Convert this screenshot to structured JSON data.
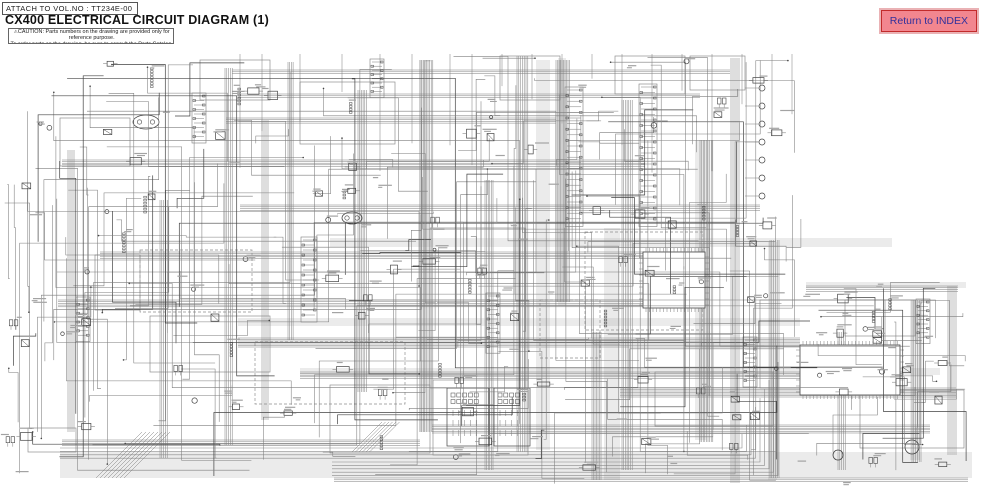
{
  "header": {
    "attach_label": "ATTACH TO VOL.NO : TT234E-00",
    "title": "CX400 ELECTRICAL CIRCUIT DIAGRAM (1)",
    "caution": {
      "icon": "⚠",
      "line1": "CAUTION: Parts numbers on the drawing are provided only for reference purpose.",
      "line2": "To order parts on the drawing, be sure to consult the Parts Catalog."
    }
  },
  "index_button": {
    "label": "Return to INDEX",
    "bg": "#f2868f",
    "border": "#c22b2b",
    "bevel": "#eab2b5",
    "text_color": "#30309c"
  },
  "diagram": {
    "description": "dense gray electrical schematic, empty top-right corner, horizontal bus lines along bottom",
    "canvas": {
      "w": 983,
      "h": 490
    },
    "seed": 20240917,
    "colors": {
      "wire": "#7d7d7d",
      "comp": "#434343",
      "smudge": "#a3a3a3",
      "module": "#8f8f8f",
      "band": "#777777",
      "bus": "#8a8a8a"
    },
    "bands": [
      [
        536,
        60,
        14,
        390
      ],
      [
        558,
        58,
        8,
        248
      ],
      [
        604,
        228,
        16,
        252
      ],
      [
        695,
        140,
        11,
        300
      ],
      [
        419,
        60,
        7,
        372
      ],
      [
        768,
        242,
        9,
        238
      ],
      [
        910,
        300,
        10,
        160
      ],
      [
        330,
        238,
        562,
        9
      ],
      [
        238,
        318,
        562,
        8
      ],
      [
        300,
        368,
        640,
        7
      ],
      [
        60,
        452,
        912,
        26
      ],
      [
        806,
        282,
        160,
        6
      ]
    ],
    "modules": [
      [
        60,
        118,
        70,
        48,
        0
      ],
      [
        140,
        250,
        112,
        62,
        1
      ],
      [
        150,
        316,
        120,
        56,
        0
      ],
      [
        255,
        342,
        150,
        62,
        1
      ],
      [
        300,
        82,
        95,
        62,
        0
      ],
      [
        430,
        228,
        95,
        160,
        0
      ],
      [
        585,
        232,
        118,
        98,
        1
      ],
      [
        433,
        380,
        95,
        75,
        0
      ],
      [
        655,
        372,
        118,
        54,
        0
      ],
      [
        760,
        300,
        125,
        88,
        0
      ],
      [
        200,
        60,
        70,
        40,
        0
      ],
      [
        95,
        255,
        45,
        55,
        0
      ],
      [
        500,
        56,
        60,
        44,
        0
      ],
      [
        615,
        56,
        70,
        38,
        0
      ],
      [
        860,
        390,
        104,
        58,
        0
      ],
      [
        28,
        428,
        48,
        24,
        0
      ],
      [
        330,
        385,
        100,
        68,
        0
      ],
      [
        690,
        56,
        55,
        34,
        0
      ],
      [
        540,
        300,
        60,
        58,
        1
      ],
      [
        845,
        300,
        70,
        36,
        0
      ]
    ],
    "v_bundles": [
      [
        225,
        68,
        445,
        5,
        1.8
      ],
      [
        420,
        60,
        432,
        9,
        1.6
      ],
      [
        517,
        56,
        452,
        7,
        1.8
      ],
      [
        556,
        60,
        302,
        10,
        1.5
      ],
      [
        622,
        100,
        470,
        7,
        1.7
      ],
      [
        700,
        140,
        442,
        9,
        1.6
      ],
      [
        731,
        58,
        483,
        5,
        2
      ],
      [
        770,
        240,
        478,
        6,
        1.8
      ],
      [
        912,
        300,
        462,
        6,
        1.8
      ],
      [
        948,
        286,
        455,
        5,
        2
      ],
      [
        358,
        90,
        392,
        6,
        1.7
      ],
      [
        262,
        120,
        420,
        4,
        2
      ],
      [
        68,
        150,
        432,
        4,
        2
      ],
      [
        160,
        200,
        458,
        5,
        1.8
      ],
      [
        485,
        180,
        470,
        6,
        1.6
      ],
      [
        592,
        332,
        480,
        7,
        1.5
      ],
      [
        838,
        332,
        470,
        5,
        1.8
      ],
      [
        288,
        62,
        340,
        4,
        1.7
      ]
    ],
    "h_bundles": [
      [
        70,
        232,
        730,
        3,
        1.8
      ],
      [
        118,
        226,
        556,
        4,
        1.7
      ],
      [
        160,
        62,
        645,
        5,
        1.6
      ],
      [
        205,
        240,
        760,
        4,
        1.8
      ],
      [
        252,
        100,
        700,
        5,
        1.6
      ],
      [
        300,
        58,
        700,
        5,
        1.7
      ],
      [
        338,
        238,
        800,
        7,
        1.5
      ],
      [
        372,
        300,
        903,
        5,
        1.6
      ],
      [
        388,
        620,
        956,
        7,
        1.5
      ],
      [
        425,
        432,
        930,
        6,
        1.6
      ],
      [
        440,
        62,
        420,
        4,
        1.8
      ],
      [
        286,
        806,
        958,
        4,
        1.8
      ],
      [
        94,
        238,
        700,
        3,
        1.8
      ],
      [
        478,
        334,
        968,
        3,
        1.8
      ]
    ],
    "bus": [
      [
        448,
        4,
        3.4,
        60
      ],
      [
        462,
        5,
        3.4,
        332
      ]
    ],
    "fans": [
      [
        96,
        478,
        8,
        4,
        46
      ],
      [
        352,
        452,
        6,
        3.5,
        30
      ]
    ],
    "strips": [
      [
        567,
        90,
        24,
        5.6,
        14
      ],
      [
        641,
        87,
        25,
        5.5,
        14
      ],
      [
        303,
        240,
        16,
        5,
        12
      ],
      [
        488,
        296,
        12,
        4.6,
        10
      ],
      [
        194,
        96,
        10,
        4.5,
        10
      ],
      [
        745,
        340,
        10,
        4.5,
        10
      ],
      [
        918,
        302,
        9,
        4.4,
        10
      ],
      [
        372,
        62,
        8,
        4.2,
        10
      ],
      [
        78,
        300,
        9,
        4.4,
        10
      ]
    ],
    "grids": [
      [
        447,
        388,
        42,
        58
      ],
      [
        494,
        388,
        36,
        58
      ]
    ],
    "pin_blocks": [
      [
        800,
        345,
        100,
        50
      ],
      [
        643,
        252,
        62,
        56
      ]
    ],
    "lamp_column": [
      762,
      88,
      7,
      18,
      3
    ],
    "ovals": [
      [
        146,
        122,
        13,
        7
      ],
      [
        352,
        218,
        10,
        6
      ]
    ],
    "circles": [
      [
        912,
        447,
        7
      ],
      [
        838,
        455,
        5
      ]
    ],
    "top_drops": [
      240,
      262,
      300,
      342,
      380,
      412,
      450,
      472,
      502,
      532,
      562,
      592,
      622,
      652,
      682,
      712,
      742,
      772,
      792
    ],
    "regions": [
      [
        32,
        56,
        268,
        420,
        26,
        34
      ],
      [
        302,
        56,
        250,
        424,
        30,
        44
      ],
      [
        554,
        56,
        248,
        428,
        30,
        44
      ],
      [
        806,
        282,
        164,
        194,
        16,
        22
      ],
      [
        2,
        170,
        34,
        290,
        5,
        6
      ]
    ],
    "long_wires": 55,
    "extra_smudges": 48
  }
}
